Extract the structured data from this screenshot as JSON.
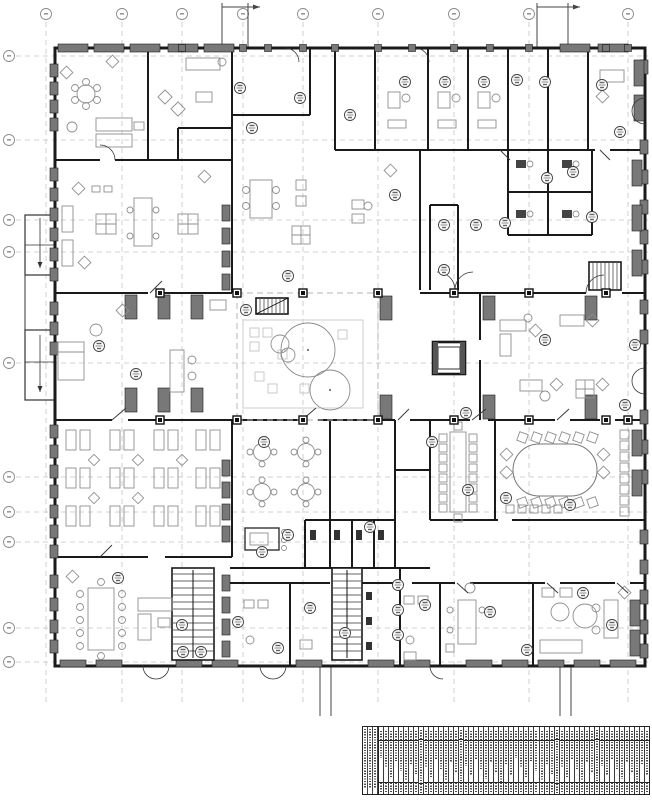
{
  "document": {
    "kind": "architectural floor plan drawing",
    "description": "building floor plan with structural grid, room tags and room schedule table",
    "readable_text_present": false
  },
  "colors": {
    "background": "#ffffff",
    "wall": "#1a1a1a",
    "grid_line": "#c4c4c4",
    "bubble_stroke": "#8a8a8a",
    "furniture": "#8f8f8f",
    "pier_fill": "#787878",
    "tag_stroke": "#3d3d3d",
    "table_ink": "#4d4d4d"
  },
  "grid": {
    "bubble_label": "",
    "top_bubbles": [
      {
        "x": 46
      },
      {
        "x": 122
      },
      {
        "x": 182
      },
      {
        "x": 243
      },
      {
        "x": 303
      },
      {
        "x": 378
      },
      {
        "x": 454
      },
      {
        "x": 529
      },
      {
        "x": 628
      }
    ],
    "left_bubbles": [
      {
        "y": 56
      },
      {
        "y": 140
      },
      {
        "y": 220
      },
      {
        "y": 252
      },
      {
        "y": 363
      },
      {
        "y": 477
      },
      {
        "y": 512
      },
      {
        "y": 542
      },
      {
        "y": 628
      },
      {
        "y": 662
      }
    ]
  },
  "section_markers": {
    "top_pairs": [
      [
        222,
        248
      ],
      [
        537,
        568
      ]
    ],
    "bottom_pairs": [
      [
        320,
        331
      ],
      [
        560,
        571
      ]
    ]
  },
  "room_tags": [
    [
      240,
      88
    ],
    [
      300,
      98
    ],
    [
      252,
      128
    ],
    [
      405,
      82
    ],
    [
      445,
      82
    ],
    [
      484,
      82
    ],
    [
      517,
      80
    ],
    [
      545,
      82
    ],
    [
      602,
      85
    ],
    [
      620,
      132
    ],
    [
      547,
      178
    ],
    [
      505,
      223
    ],
    [
      573,
      172
    ],
    [
      592,
      217
    ],
    [
      288,
      276
    ],
    [
      350,
      115
    ],
    [
      395,
      195
    ],
    [
      444,
      225
    ],
    [
      444,
      270
    ],
    [
      99,
      346
    ],
    [
      136,
      374
    ],
    [
      246,
      310
    ],
    [
      476,
      225
    ],
    [
      635,
      345
    ],
    [
      625,
      405
    ],
    [
      545,
      340
    ],
    [
      264,
      442
    ],
    [
      432,
      442
    ],
    [
      468,
      490
    ],
    [
      506,
      498
    ],
    [
      570,
      505
    ],
    [
      288,
      535
    ],
    [
      262,
      552
    ],
    [
      370,
      527
    ],
    [
      118,
      578
    ],
    [
      182,
      625
    ],
    [
      183,
      652
    ],
    [
      201,
      652
    ],
    [
      238,
      622
    ],
    [
      278,
      648
    ],
    [
      310,
      608
    ],
    [
      345,
      633
    ],
    [
      398,
      585
    ],
    [
      398,
      610
    ],
    [
      398,
      635
    ],
    [
      425,
      605
    ],
    [
      490,
      612
    ],
    [
      583,
      593
    ],
    [
      527,
      650
    ],
    [
      612,
      625
    ],
    [
      466,
      413
    ]
  ],
  "legend_table": {
    "x": 362,
    "y": 726,
    "width": 288,
    "height": 69,
    "left_columns": 3,
    "columns": 54,
    "header_rows": 2,
    "footer_rows": 2,
    "text_legible": false
  }
}
